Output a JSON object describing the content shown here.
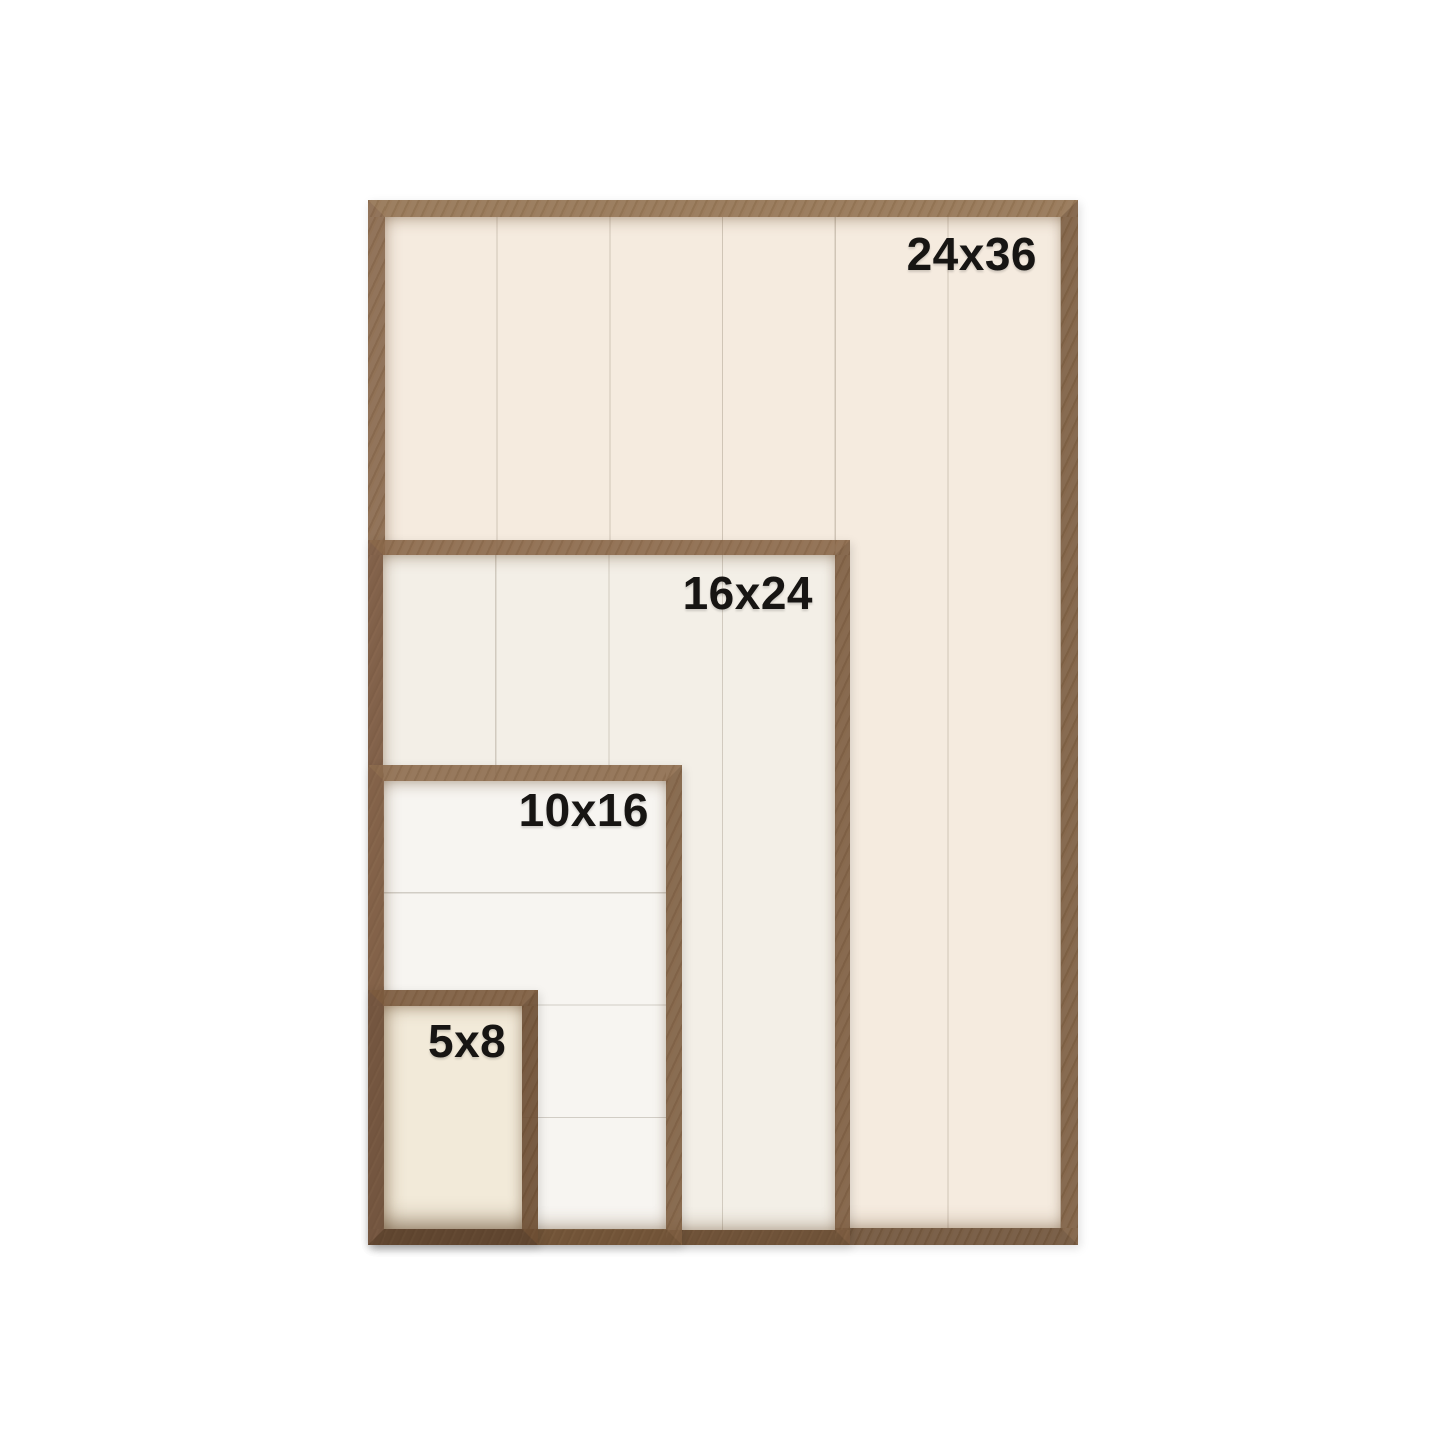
{
  "figure": {
    "type": "frame-size-comparison",
    "background_color": "#ffffff",
    "label_color": "#171513",
    "wood_color": "#7d5c3f",
    "frames": [
      {
        "label": "24x36",
        "panel_color": "#f5ebdf",
        "plank_direction": "vertical",
        "plank_count": 6
      },
      {
        "label": "16x24",
        "panel_color": "#f3efe7",
        "plank_direction": "vertical",
        "plank_count": 4
      },
      {
        "label": "10x16",
        "panel_color": "#f7f5f1",
        "plank_direction": "horizontal",
        "plank_count": 4
      },
      {
        "label": "5x8",
        "panel_color": "#f2ead9",
        "plank_direction": "none",
        "plank_count": 1
      }
    ]
  }
}
